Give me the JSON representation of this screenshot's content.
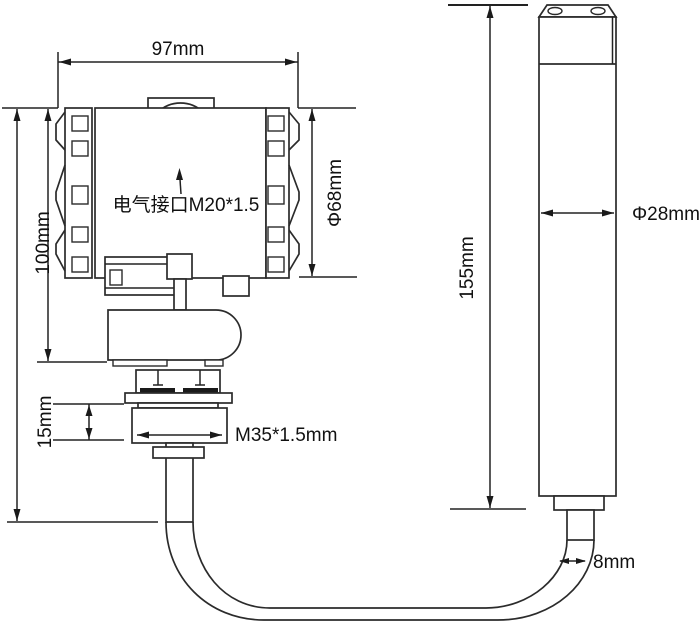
{
  "drawing": {
    "kind": "pressure-level-transmitter-dimension-drawing",
    "labels": {
      "body_width": "97mm",
      "body_height": "100mm",
      "body_diameter": "Φ68mm",
      "electrical_interface": "电气接口M20*1.5",
      "nut_height": "15mm",
      "mounting_thread": "M35*1.5mm",
      "probe_length": "155mm",
      "probe_diameter": "Φ28mm",
      "cable_diameter": "8mm"
    },
    "colors": {
      "line": "#2b2b2b",
      "dimension_line": "#222222",
      "text": "#111111",
      "background": "#ffffff"
    }
  }
}
